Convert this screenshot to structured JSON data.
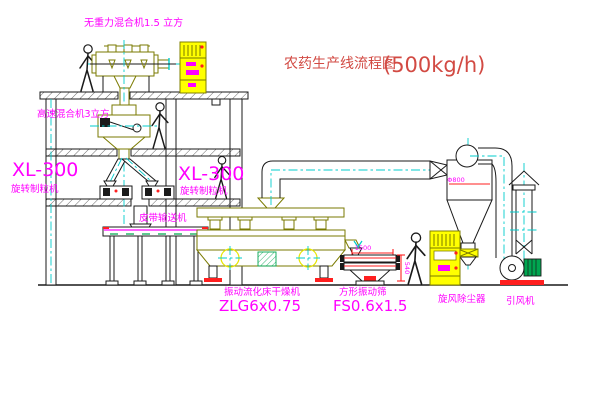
{
  "title": {
    "text": "农药生产线流程图",
    "capacity": "(500kg/h)"
  },
  "labels": {
    "gravity_mixer": "无重力混合机1.5 立方",
    "high_speed_mixer": "高速混合机3立方",
    "granulator_left_model": "XL-300",
    "granulator_left_name": "旋转制粒机",
    "granulator_right_model": "XL-300",
    "granulator_right_name": "旋转制粒机",
    "belt_conveyor": "皮带输送机",
    "dryer_name": "振动流化床干燥机",
    "dryer_model": "ZLG6x0.75",
    "sieve_name": "方形振动筛",
    "sieve_model": "FS0.6x1.5",
    "cyclone_name": "旋风除尘器",
    "fan_name": "引风机"
  },
  "dimensions": {
    "sieve_width": "1500",
    "sieve_height": "540",
    "cyclone_diameter": "Φ800"
  },
  "colors": {
    "label_text": "#ff00ff",
    "title_text": "#d24a43",
    "centerline": "#00cccc",
    "machine_outline": "#7a7a00",
    "structure": "#1a1a1a",
    "cabinet_fill": "#ffff00",
    "accent_red": "#ff1f1f",
    "motor_green": "#00a650"
  }
}
